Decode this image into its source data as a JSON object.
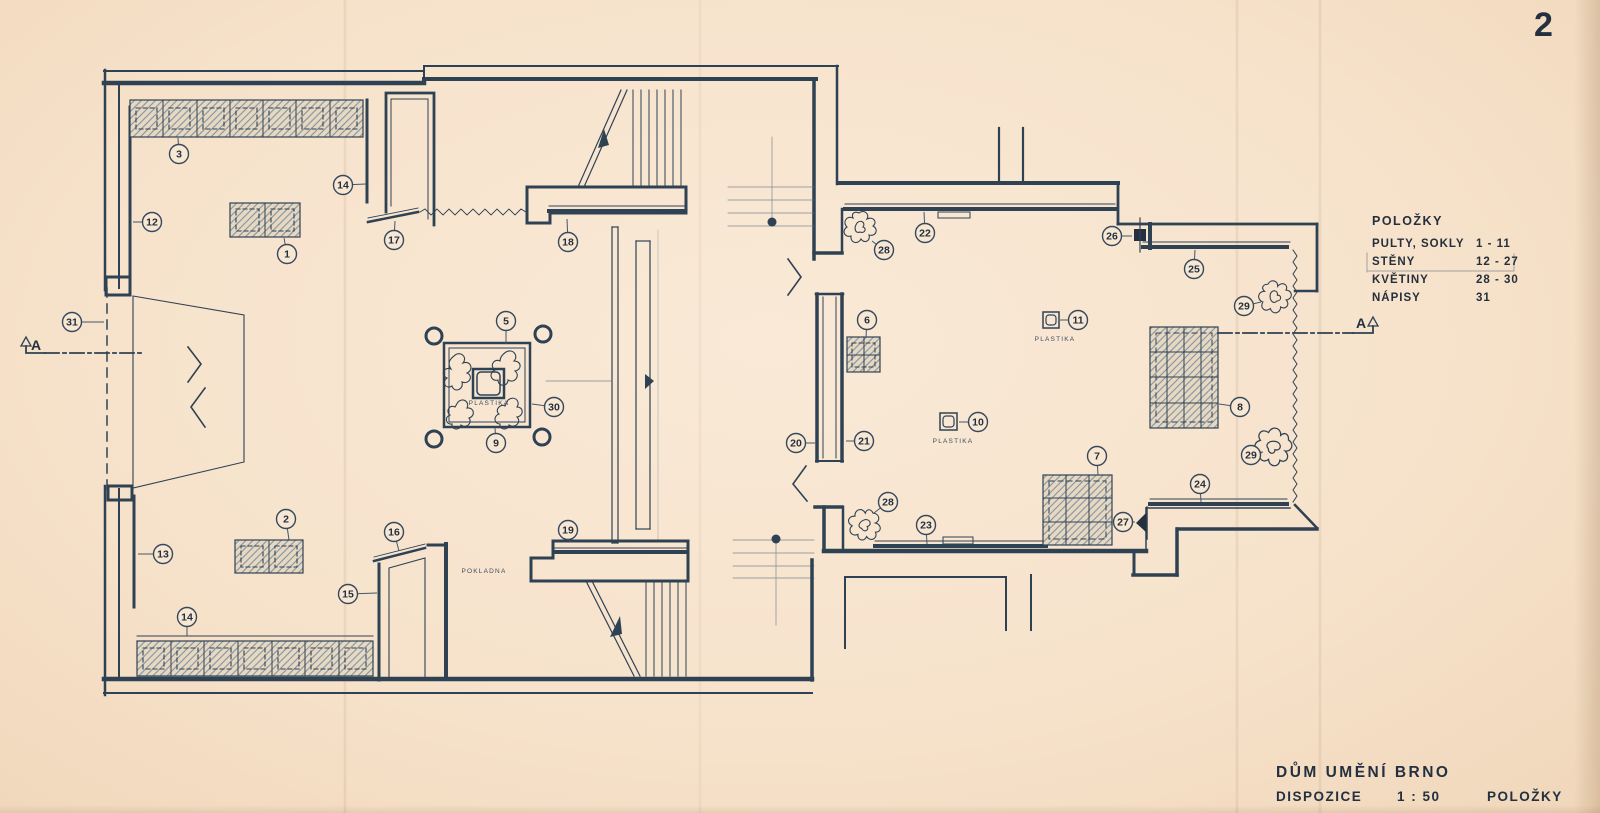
{
  "page_number": "2",
  "legend": {
    "title": "POLOŽKY",
    "rows": [
      {
        "label": "PULTY, SOKLY",
        "value": "1 - 11"
      },
      {
        "label": "STĚNY",
        "value": "12 - 27"
      },
      {
        "label": "KVĚTINY",
        "value": "28 - 30"
      },
      {
        "label": "NÁPISY",
        "value": "31"
      }
    ]
  },
  "title_block": {
    "project": "DŮM UMĚNÍ BRNO",
    "drawing": "DISPOZICE",
    "scale": "1 : 50",
    "sheet": "POLOŽKY"
  },
  "section_markers": [
    {
      "label": "A"
    },
    {
      "label": "A"
    }
  ],
  "plan_labels": [
    {
      "text": "PLASTIKA",
      "x": 489,
      "y": 405
    },
    {
      "text": "PLASTIKA",
      "x": 1055,
      "y": 341
    },
    {
      "text": "PLASTIKA",
      "x": 953,
      "y": 443
    },
    {
      "text": "POKLADNA",
      "x": 484,
      "y": 573
    }
  ],
  "item_markers": [
    {
      "n": "1",
      "x": 287,
      "y": 254,
      "lx": 284,
      "ly": 238
    },
    {
      "n": "2",
      "x": 286,
      "y": 519,
      "lx": 289,
      "ly": 540
    },
    {
      "n": "3",
      "x": 179,
      "y": 154,
      "lx": 178,
      "ly": 138
    },
    {
      "n": "5",
      "x": 506,
      "y": 321,
      "lx": 506,
      "ly": 344
    },
    {
      "n": "6",
      "x": 867,
      "y": 320,
      "lx": 866,
      "ly": 337
    },
    {
      "n": "7",
      "x": 1097,
      "y": 456,
      "lx": 1098,
      "ly": 475
    },
    {
      "n": "8",
      "x": 1240,
      "y": 407,
      "lx": 1219,
      "ly": 404
    },
    {
      "n": "9",
      "x": 496,
      "y": 443,
      "lx": 495,
      "ly": 428
    },
    {
      "n": "10",
      "x": 978,
      "y": 422,
      "lx": 959,
      "ly": 422
    },
    {
      "n": "11",
      "x": 1078,
      "y": 320,
      "lx": 1060,
      "ly": 320
    },
    {
      "n": "12",
      "x": 152,
      "y": 222,
      "lx": 133,
      "ly": 222
    },
    {
      "n": "13",
      "x": 163,
      "y": 554,
      "lx": 138,
      "ly": 554
    },
    {
      "n": "14",
      "x": 343,
      "y": 185,
      "lx": 366,
      "ly": 184
    },
    {
      "n": "14",
      "x": 187,
      "y": 617,
      "lx": 187,
      "ly": 636
    },
    {
      "n": "15",
      "x": 348,
      "y": 594,
      "lx": 377,
      "ly": 593
    },
    {
      "n": "16",
      "x": 394,
      "y": 532,
      "lx": 399,
      "ly": 551
    },
    {
      "n": "17",
      "x": 394,
      "y": 240,
      "lx": 395,
      "ly": 221
    },
    {
      "n": "18",
      "x": 568,
      "y": 242,
      "lx": 567,
      "ly": 219
    },
    {
      "n": "19",
      "x": 568,
      "y": 530,
      "lx": 570,
      "ly": 542
    },
    {
      "n": "20",
      "x": 796,
      "y": 443,
      "lx": 815,
      "ly": 443
    },
    {
      "n": "21",
      "x": 864,
      "y": 441,
      "lx": 846,
      "ly": 441
    },
    {
      "n": "22",
      "x": 925,
      "y": 233,
      "lx": 924,
      "ly": 212
    },
    {
      "n": "23",
      "x": 926,
      "y": 525,
      "lx": 927,
      "ly": 544
    },
    {
      "n": "24",
      "x": 1200,
      "y": 484,
      "lx": 1201,
      "ly": 502
    },
    {
      "n": "25",
      "x": 1194,
      "y": 269,
      "lx": 1195,
      "ly": 250
    },
    {
      "n": "26",
      "x": 1112,
      "y": 236,
      "lx": 1132,
      "ly": 236
    },
    {
      "n": "27",
      "x": 1123,
      "y": 522,
      "lx": 1135,
      "ly": 522
    },
    {
      "n": "28",
      "x": 884,
      "y": 250,
      "lx": 872,
      "ly": 241
    },
    {
      "n": "28",
      "x": 888,
      "y": 502,
      "lx": 874,
      "ly": 513
    },
    {
      "n": "29",
      "x": 1244,
      "y": 306,
      "lx": 1261,
      "ly": 302
    },
    {
      "n": "29",
      "x": 1251,
      "y": 455,
      "lx": 1263,
      "ly": 452
    },
    {
      "n": "30",
      "x": 554,
      "y": 407,
      "lx": 532,
      "ly": 404
    },
    {
      "n": "31",
      "x": 72,
      "y": 322,
      "lx": 104,
      "ly": 322
    }
  ],
  "colors": {
    "paper": "#f8e7d2",
    "ink": "#2f4254",
    "ink_dark": "#22303f",
    "hatch": "#8494a2"
  }
}
